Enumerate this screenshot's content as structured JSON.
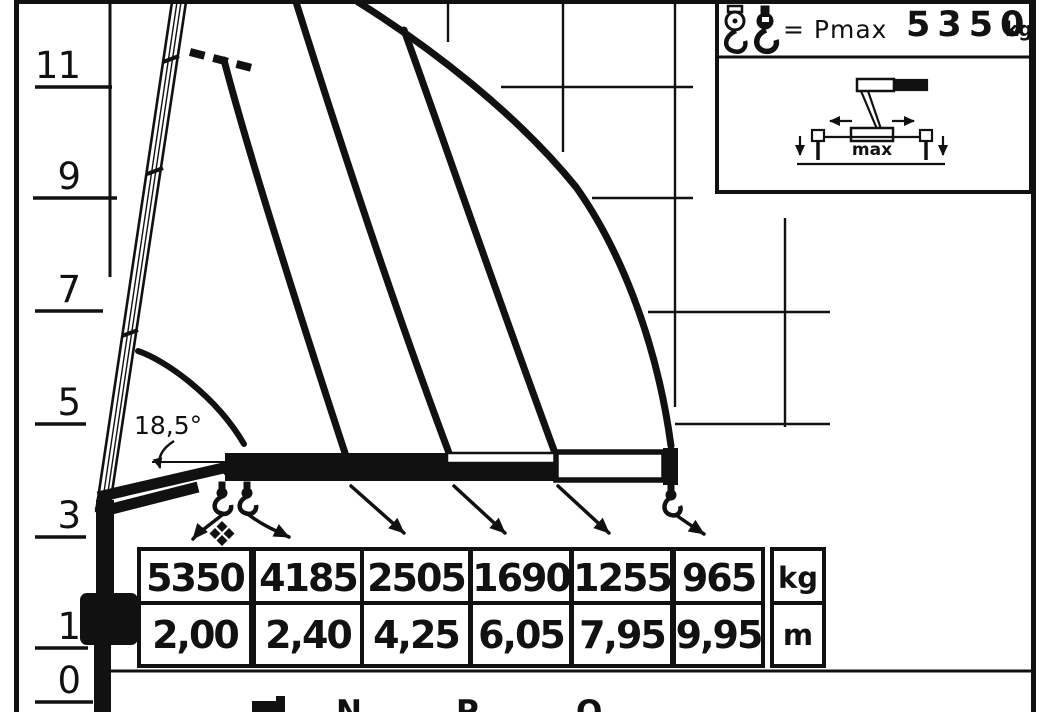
{
  "title": "Crane lifting capacity diagram",
  "axis": {
    "unit_labels": [
      "11",
      "9",
      "7",
      "5",
      "3",
      "1",
      "0"
    ]
  },
  "angle_label": "18,5°",
  "legend": {
    "hook_icons": [
      "hook-block-icon",
      "hook-icon"
    ],
    "pmax_equation": "= Pmax",
    "pmax_value": "5350",
    "pmax_unit": "kg",
    "outrigger_label": "max"
  },
  "load_table": {
    "columns": [
      {
        "load_kg": "5350",
        "reach_m": "2,00"
      },
      {
        "load_kg": "4185",
        "reach_m": "2,40"
      },
      {
        "load_kg": "2505",
        "reach_m": "4,25"
      },
      {
        "load_kg": "1690",
        "reach_m": "6,05"
      },
      {
        "load_kg": "1255",
        "reach_m": "7,95"
      },
      {
        "load_kg": "965",
        "reach_m": "9,95"
      }
    ],
    "unit_rows": [
      "kg",
      "m"
    ]
  },
  "footer": {
    "variant_labels": [
      "N",
      "P",
      "Q"
    ]
  },
  "chart_data": {
    "type": "line",
    "title": "Crane load capacity vs reach",
    "xlabel": "reach (m)",
    "ylabel": "height above ground (m)",
    "ylim": [
      0,
      12
    ],
    "height_ticks_m": [
      11,
      9,
      7,
      5,
      3,
      1,
      0
    ],
    "max_capacity_kg": 5350,
    "min_boom_angle_deg": 18.5,
    "series": [
      {
        "name": "rated load at reach",
        "points": [
          {
            "reach_m": 2.0,
            "load_kg": 5350
          },
          {
            "reach_m": 2.4,
            "load_kg": 4185
          },
          {
            "reach_m": 4.25,
            "load_kg": 2505
          },
          {
            "reach_m": 6.05,
            "load_kg": 1690
          },
          {
            "reach_m": 7.95,
            "load_kg": 1255
          },
          {
            "reach_m": 9.95,
            "load_kg": 965
          }
        ]
      }
    ],
    "legend_position": "top-right",
    "grid": "partial"
  }
}
